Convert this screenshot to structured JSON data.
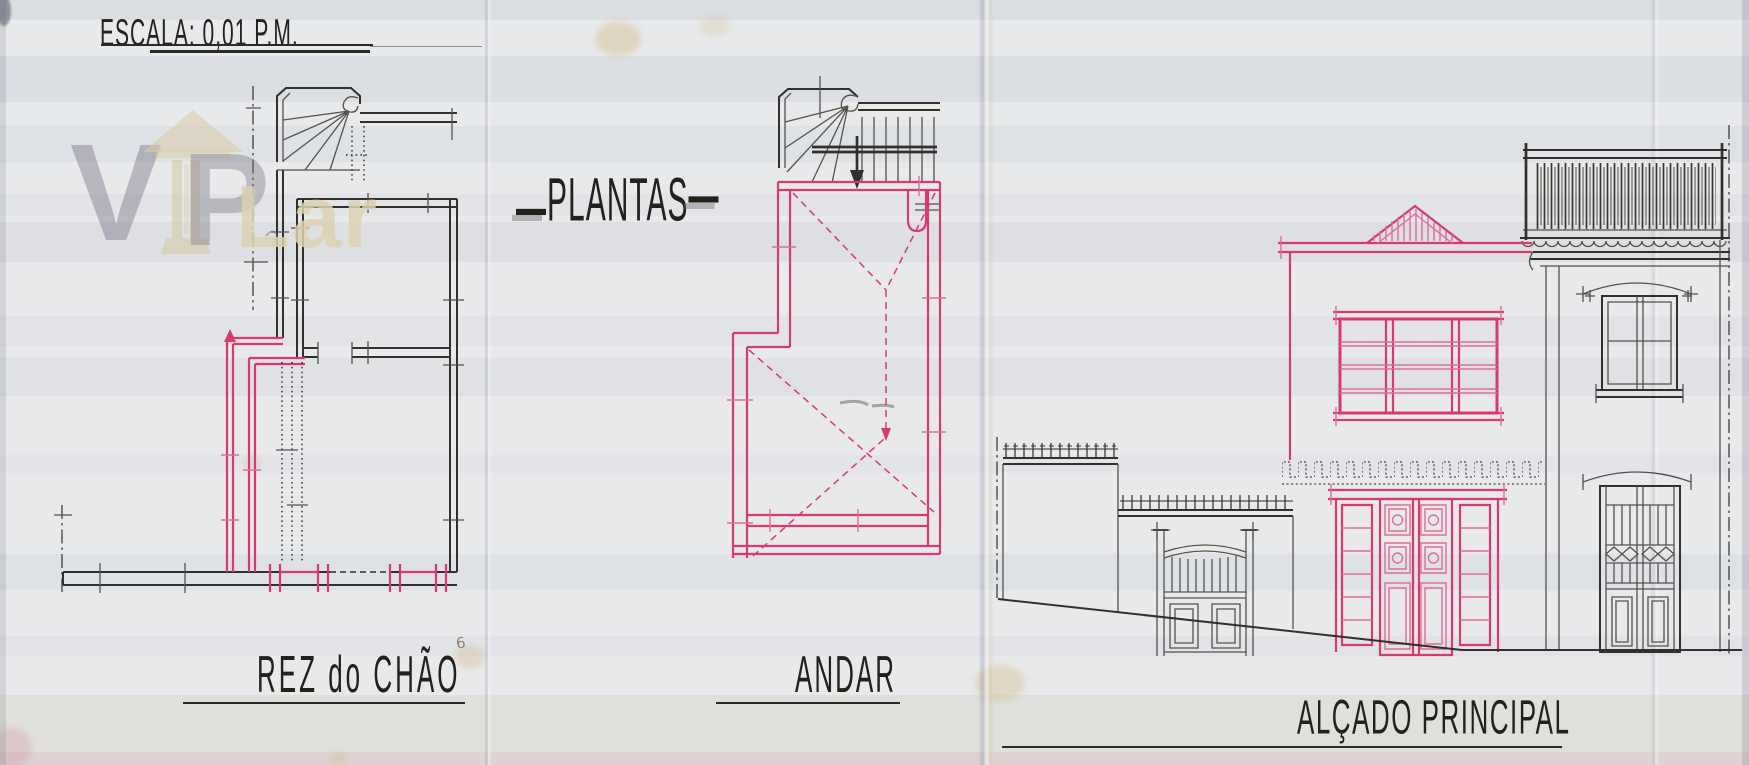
{
  "document": {
    "scale_note": "ESCALA: 0,01 P.M.",
    "sheet_number": "6"
  },
  "titles": {
    "plans_title": "PLANTAS",
    "title_dash": "—"
  },
  "drawings": {
    "ground_floor": {
      "label": "REZ do CHÃO"
    },
    "upper_floor": {
      "label": "ANDAR"
    },
    "elevation": {
      "label": "ALÇADO PRINCIPAL"
    }
  },
  "watermark": {
    "v": "V",
    "p": "P",
    "lar": "Lar"
  },
  "colors": {
    "paper": "#e8e9eb",
    "ink": "#33302c",
    "ink_light": "#55524d",
    "pink": "#d63a6e",
    "pink_light": "#e06d96",
    "watermark_gray": "#74717f",
    "watermark_beige": "#d8cba8"
  }
}
